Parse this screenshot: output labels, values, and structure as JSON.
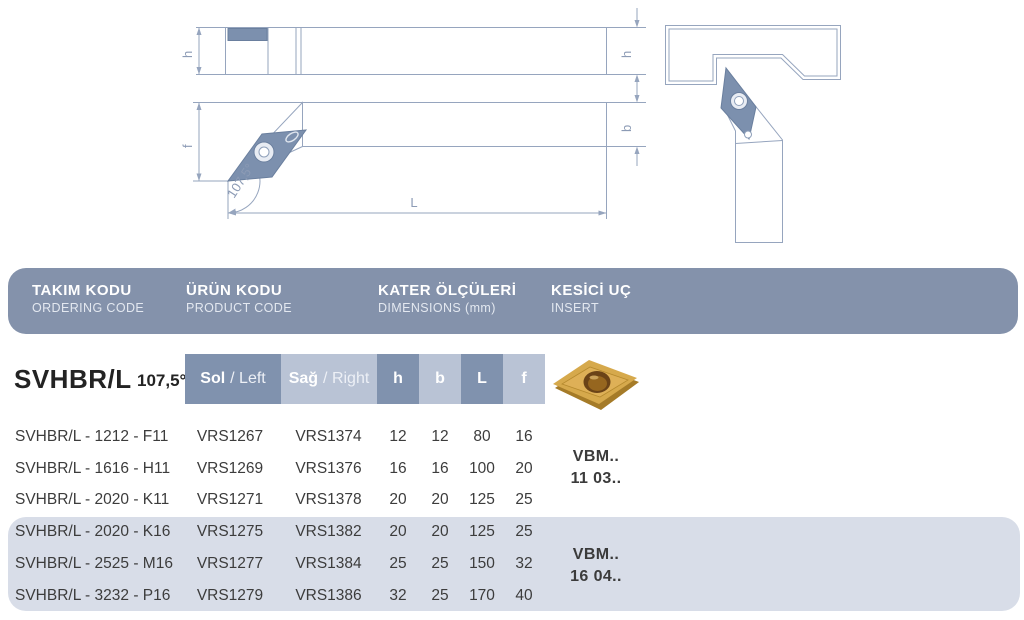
{
  "drawing": {
    "h_left": "h",
    "h_right": "h",
    "f": "f",
    "b": "b",
    "L": "L",
    "angle": "107,5°"
  },
  "header": {
    "columns": [
      {
        "title": "TAKIM KODU",
        "subtitle": "ORDERING CODE"
      },
      {
        "title": "ÜRÜN KODU",
        "subtitle": "PRODUCT CODE"
      },
      {
        "title": "KATER ÖLÇÜLERİ",
        "subtitle": "DIMENSIONS (mm)"
      },
      {
        "title": "KESİCİ UÇ",
        "subtitle": "INSERT"
      }
    ]
  },
  "subheader": {
    "model": "SVHBR/L",
    "angle": "107,5°",
    "sol_tr": "Sol",
    "sol_en": "/ Left",
    "sag_tr": "Sağ",
    "sag_en": "/ Right",
    "dims": [
      "h",
      "b",
      "L",
      "f"
    ]
  },
  "table": {
    "rows": [
      {
        "ordering": "SVHBR/L - 1212 - F11",
        "left_code": "VRS1267",
        "right_code": "VRS1374",
        "h": "12",
        "b": "12",
        "L": "80",
        "f": "16"
      },
      {
        "ordering": "SVHBR/L - 1616 - H11",
        "left_code": "VRS1269",
        "right_code": "VRS1376",
        "h": "16",
        "b": "16",
        "L": "100",
        "f": "20"
      },
      {
        "ordering": "SVHBR/L - 2020 - K11",
        "left_code": "VRS1271",
        "right_code": "VRS1378",
        "h": "20",
        "b": "20",
        "L": "125",
        "f": "25"
      },
      {
        "ordering": "SVHBR/L - 2020 - K16",
        "left_code": "VRS1275",
        "right_code": "VRS1382",
        "h": "20",
        "b": "20",
        "L": "125",
        "f": "25"
      },
      {
        "ordering": "SVHBR/L - 2525 - M16",
        "left_code": "VRS1277",
        "right_code": "VRS1384",
        "h": "25",
        "b": "25",
        "L": "150",
        "f": "32"
      },
      {
        "ordering": "SVHBR/L - 3232 - P16",
        "left_code": "VRS1279",
        "right_code": "VRS1386",
        "h": "32",
        "b": "25",
        "L": "170",
        "f": "40"
      }
    ],
    "insert_groups": [
      {
        "line1": "VBM..",
        "line2": "11 03.."
      },
      {
        "line1": "VBM..",
        "line2": "16 04.."
      }
    ]
  },
  "colors": {
    "header_bar": "#8492ab",
    "cell_dark": "#8092ae",
    "cell_light": "#b9c3d5",
    "row_band": "#d8dde8",
    "drawing_line": "#96a5be",
    "insert_blue": "#7c90ae",
    "insert_gold": "#d6a94c"
  }
}
